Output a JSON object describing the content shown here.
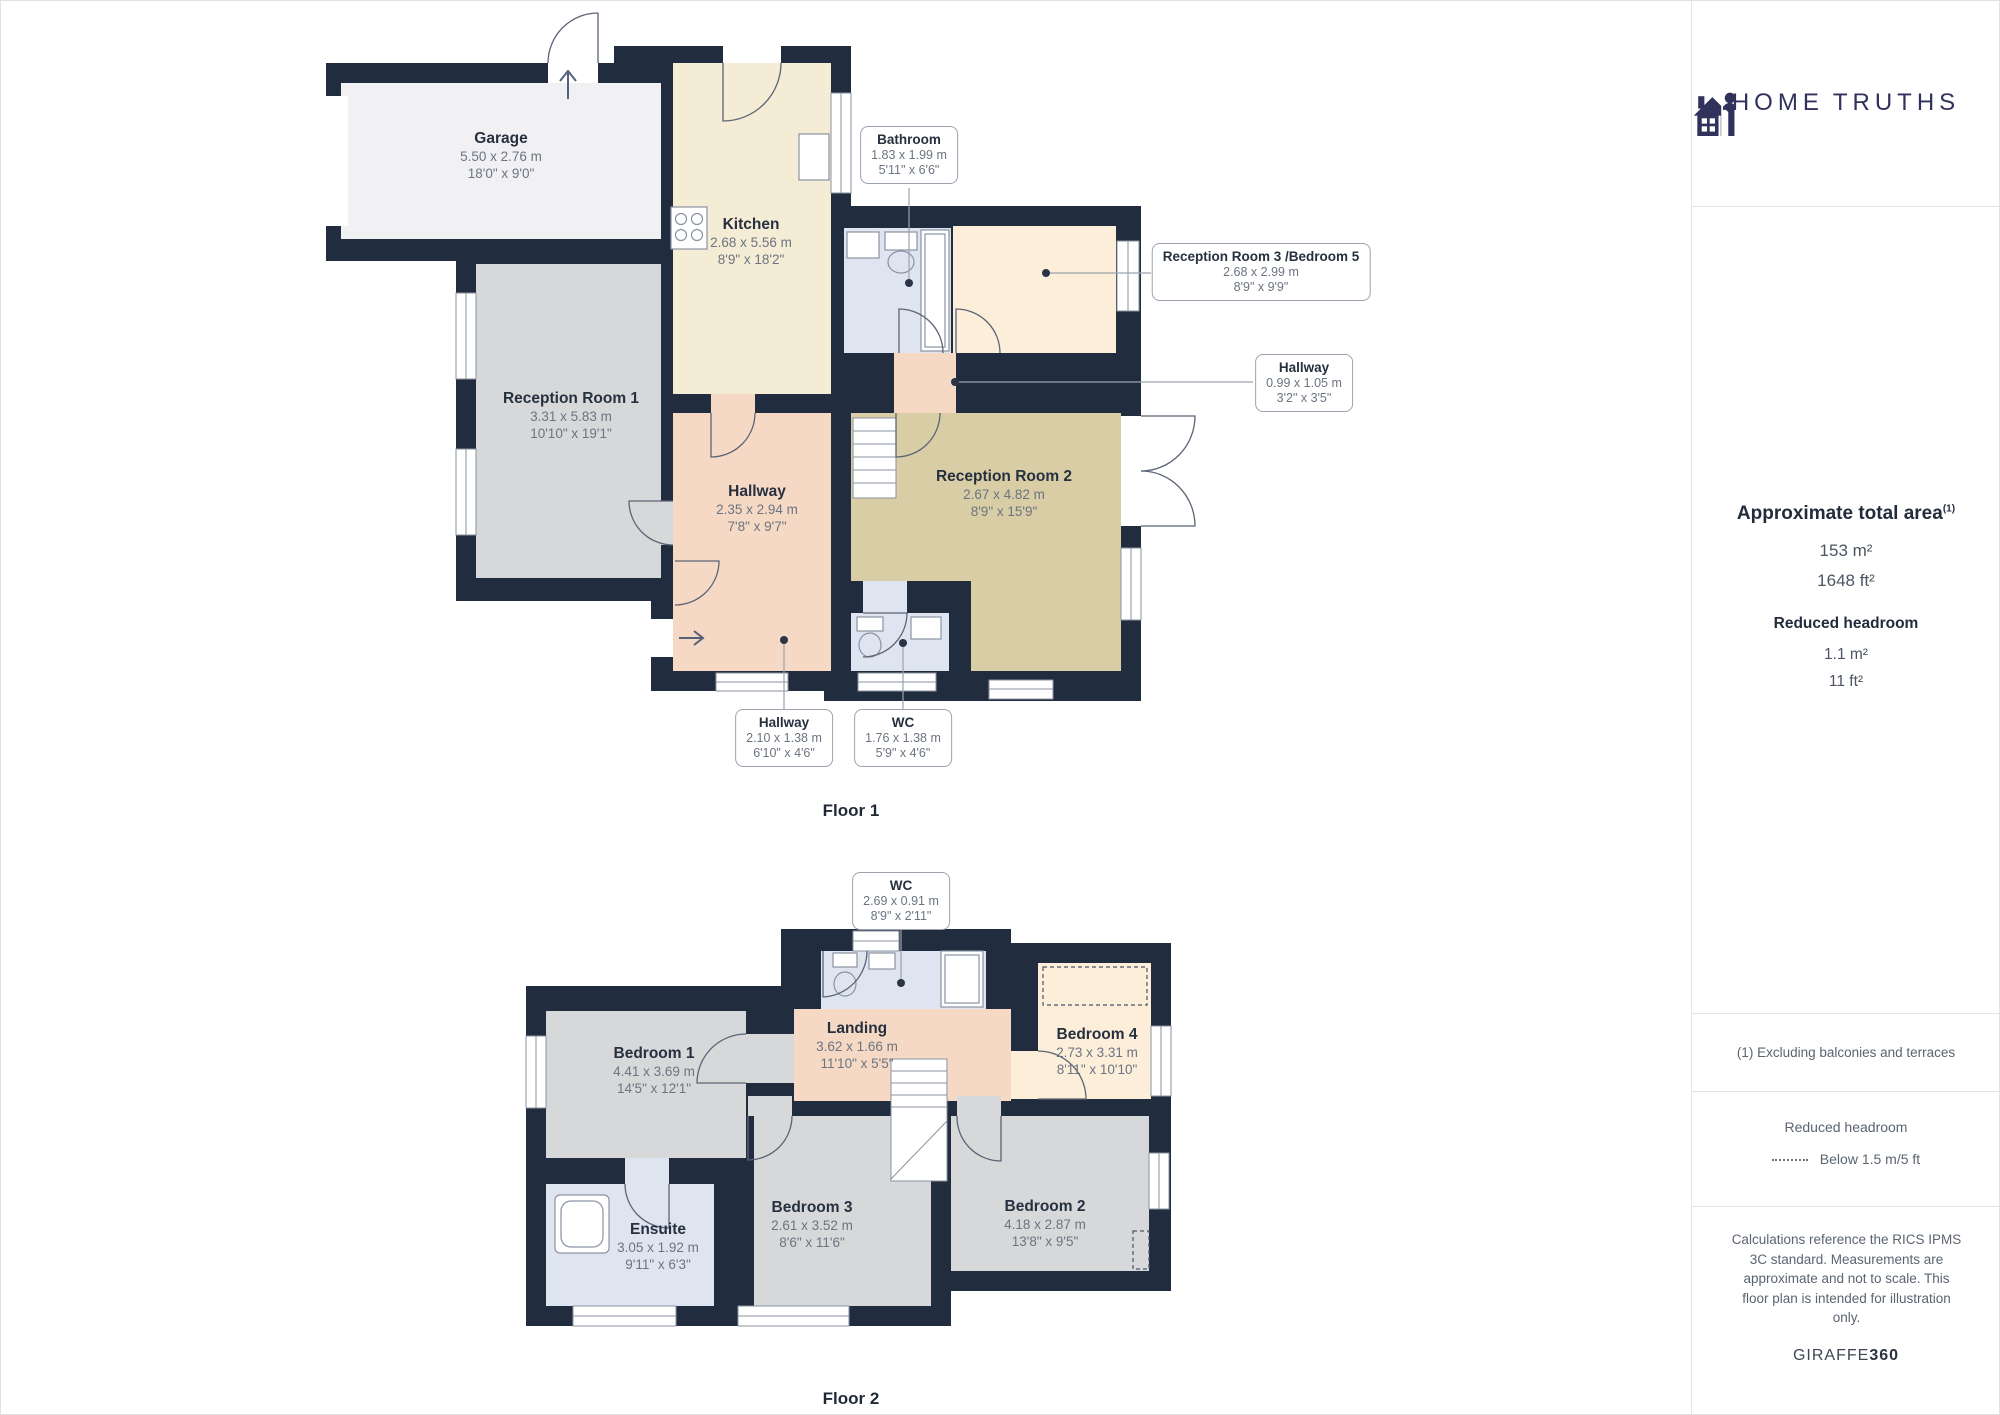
{
  "branding": {
    "logo_left": "HOME",
    "logo_right": "TRUTHS",
    "giraffe_brand": "GIRAFFE",
    "giraffe_suffix": "360"
  },
  "colors": {
    "wall": "#212c3f",
    "logo_navy": "#31325c",
    "garage_fill": "#f1f1f3",
    "gray_room": "#d7d8da",
    "kitchen_cream": "#f4ecd5",
    "reception2_tan": "#d9cda6",
    "hallway_peach": "#f6d9c5",
    "light_peach": "#fdeeda",
    "bath_blue": "#dfe4f1"
  },
  "sidebar": {
    "area_title": "Approximate total area",
    "area_superscript": "(1)",
    "area_m2": "153 m²",
    "area_ft2": "1648 ft²",
    "headroom_title": "Reduced headroom",
    "headroom_m2": "1.1 m²",
    "headroom_ft2": "11 ft²",
    "footnote": "(1) Excluding balconies and terraces",
    "legend_title": "Reduced headroom",
    "legend_label": "Below 1.5 m/5 ft",
    "disclaimer_lines": {
      "l1": "Calculations reference the RICS IPMS",
      "l2": "3C standard. Measurements are",
      "l3": "approximate and not to scale. This",
      "l4": "floor plan is intended for illustration",
      "l5": "only."
    }
  },
  "floor1": {
    "caption": "Floor 1",
    "rooms": {
      "garage": {
        "name": "Garage",
        "metric": "5.50 x 2.76 m",
        "imperial": "18'0\" x 9'0\""
      },
      "kitchen": {
        "name": "Kitchen",
        "metric": "2.68 x 5.56 m",
        "imperial": "8'9\" x 18'2\""
      },
      "reception1": {
        "name": "Reception Room 1",
        "metric": "3.31 x 5.83 m",
        "imperial": "10'10\" x 19'1\""
      },
      "hallway": {
        "name": "Hallway",
        "metric": "2.35 x 2.94 m",
        "imperial": "7'8\" x 9'7\""
      },
      "reception2": {
        "name": "Reception Room 2",
        "metric": "2.67 x 4.82 m",
        "imperial": "8'9\" x 15'9\""
      }
    },
    "boxes": {
      "bathroom": {
        "name": "Bathroom",
        "metric": "1.83 x 1.99 m",
        "imperial": "5'11\" x 6'6\""
      },
      "reception3": {
        "name": "Reception Room 3 /Bedroom 5",
        "metric": "2.68 x 2.99 m",
        "imperial": "8'9\" x 9'9\""
      },
      "hallway_small": {
        "name": "Hallway",
        "metric": "0.99 x 1.05 m",
        "imperial": "3'2\" x 3'5\""
      },
      "hallway_lower": {
        "name": "Hallway",
        "metric": "2.10 x 1.38 m",
        "imperial": "6'10\" x 4'6\""
      },
      "wc": {
        "name": "WC",
        "metric": "1.76 x 1.38 m",
        "imperial": "5'9\" x 4'6\""
      }
    }
  },
  "floor2": {
    "caption": "Floor 2",
    "rooms": {
      "bedroom1": {
        "name": "Bedroom 1",
        "metric": "4.41 x 3.69 m",
        "imperial": "14'5\" x 12'1\""
      },
      "landing": {
        "name": "Landing",
        "metric": "3.62 x 1.66 m",
        "imperial": "11'10\" x 5'5\""
      },
      "bedroom4": {
        "name": "Bedroom 4",
        "metric": "2.73 x 3.31 m",
        "imperial": "8'11\" x 10'10\""
      },
      "ensuite": {
        "name": "Ensuite",
        "metric": "3.05 x 1.92 m",
        "imperial": "9'11\" x 6'3\""
      },
      "bedroom3": {
        "name": "Bedroom 3",
        "metric": "2.61 x 3.52 m",
        "imperial": "8'6\" x 11'6\""
      },
      "bedroom2": {
        "name": "Bedroom 2",
        "metric": "4.18 x 2.87 m",
        "imperial": "13'8\" x 9'5\""
      }
    },
    "boxes": {
      "wc": {
        "name": "WC",
        "metric": "2.69 x 0.91 m",
        "imperial": "8'9\" x 2'11\""
      }
    }
  }
}
